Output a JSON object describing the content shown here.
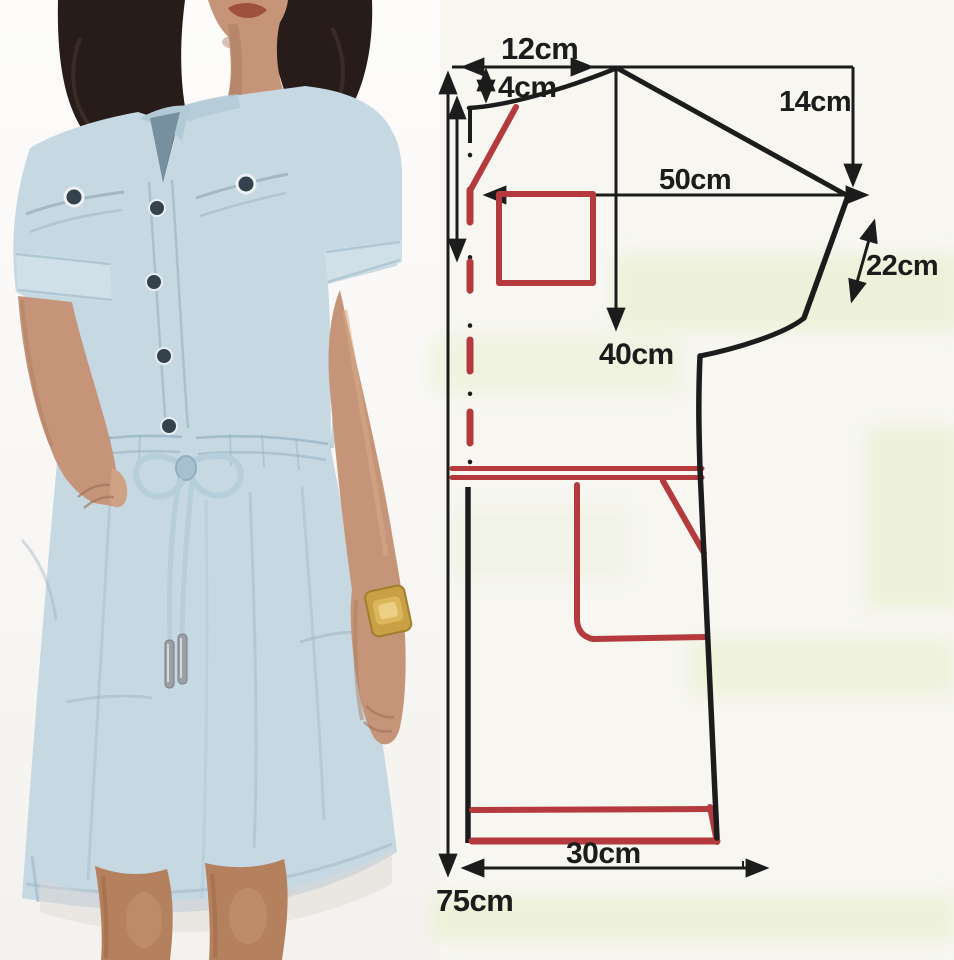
{
  "measurements": {
    "neck_width": "12cm",
    "front_neck_depth": "4cm",
    "sleeve_drop": "14cm",
    "chest_width": "50cm",
    "sleeve_edge_length": "22cm",
    "chest_depth": "40cm",
    "hem_width": "30cm",
    "garment_length": "75cm"
  },
  "colors": {
    "line": "#1c1c1c",
    "accent": "#b43a3e",
    "paper": "#f7f6f1",
    "paper_tint": "#e9f0cf",
    "dress_blue": "#c6d8e2",
    "dress_light": "#d6e3ea",
    "dress_shade": "#9db8c6",
    "skin": "#c69579",
    "skin_shade": "#a87a5e",
    "hair": "#271c19",
    "legs": "#b5805d",
    "watch_gold": "#c9a144",
    "button": "#34424d",
    "cord": "#b7cedb",
    "aglet": "#9aa0a5"
  }
}
